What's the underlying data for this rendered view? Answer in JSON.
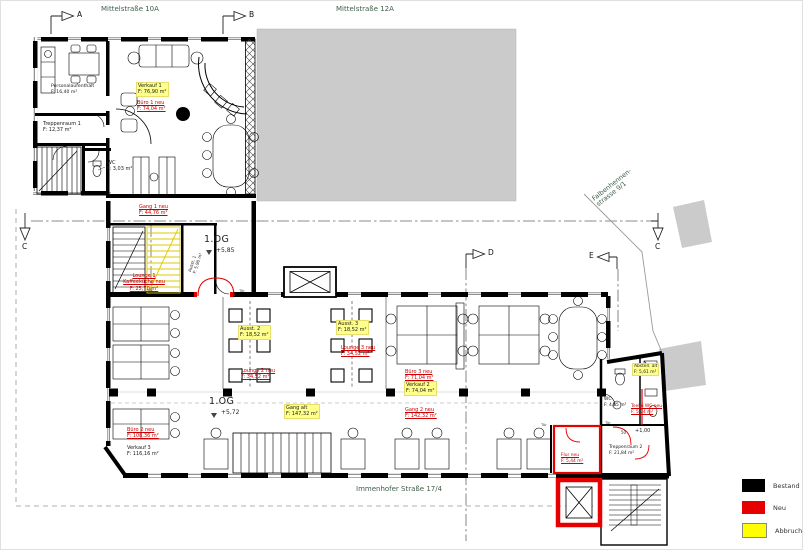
{
  "streets": {
    "top_left": "Mittelstraße 10A",
    "top_right": "Mittelstraße 12A",
    "bottom": "Immenhofer Straße 17/4",
    "right_line1": "Falbenhennen-",
    "right_line2": "strasse 9/1"
  },
  "markers": {
    "a": "A",
    "b": "B",
    "c_left": "C",
    "c_right": "C",
    "d": "D",
    "e": "E"
  },
  "levels": {
    "og585": {
      "name": "1.OG",
      "value": "+5,85"
    },
    "og572": {
      "name": "1.OG",
      "value": "+5,72"
    },
    "entry": {
      "value": "+1,00"
    },
    "door_width": "50"
  },
  "door_label": "Tür",
  "rooms": {
    "personalaufenthalt": {
      "name": "Personalaufenthalt",
      "area": "F: 16,40 m²",
      "status": "bestand"
    },
    "treppenraum1": {
      "name": "Treppenraum 1",
      "area": "F: 12,37 m²",
      "status": "bestand"
    },
    "wc1": {
      "name": "WC",
      "area": "F: 3,03 m²",
      "status": "bestand"
    },
    "verkauf1": {
      "name": "Verkauf 1",
      "area": "F: 76,90 m²",
      "status": "abbruch"
    },
    "buero1": {
      "name": "Büro 1 neu",
      "area": "F: 74,04 m²",
      "status": "neu"
    },
    "gang1": {
      "name": "Gang 1 neu",
      "area": "F: 44,76 m²",
      "status": "neu"
    },
    "lounge1": {
      "name": "Lounge 1 Kaffeeküche neu",
      "area": "F: 25,70 m²",
      "status": "neu"
    },
    "ausst1": {
      "name": "Ausst. 1",
      "area": "F: 5,90 m²",
      "status": "bestand"
    },
    "ausst2": {
      "name": "Ausst. 2",
      "area": "F: 18,52 m²",
      "status": "abbruch"
    },
    "lounge2": {
      "name": "Lounge 2 neu",
      "area": "F: 34,52 m²",
      "status": "neu"
    },
    "ausst3": {
      "name": "Ausst. 3",
      "area": "F: 18,52 m²",
      "status": "abbruch"
    },
    "lounge3": {
      "name": "Lounge 3 neu",
      "area": "F: 34,52 m²",
      "status": "neu"
    },
    "buero3": {
      "name": "Büro 3 neu",
      "area": "F: 71,04 m²",
      "status": "neu"
    },
    "verkauf2": {
      "name": "Verkauf 2",
      "area": "F: 74,04 m²",
      "status": "abbruch"
    },
    "gang_alt": {
      "name": "Gang alt",
      "area": "F: 147,32 m²",
      "status": "abbruch"
    },
    "gang2": {
      "name": "Gang 2 neu",
      "area": "F: 142,32 m²",
      "status": "neu"
    },
    "buero2": {
      "name": "Büro 2 neu",
      "area": "F: 108,36 m²",
      "status": "neu"
    },
    "verkauf3": {
      "name": "Verkauf 3",
      "area": "F: 116,16 m²",
      "status": "bestand"
    },
    "wc2": {
      "name": "WC",
      "area": "F: 4,45 m²",
      "status": "bestand"
    },
    "teekue": {
      "name": "Teekü WC neu",
      "area": "F: 5,74 m²",
      "status": "neu"
    },
    "abstell": {
      "name": "Abstell. alt",
      "area": "F: 5,61 m²",
      "status": "abbruch"
    },
    "treppenraum2": {
      "name": "Treppenraum 2",
      "area": "F: 21,84 m²",
      "status": "bestand"
    },
    "flur_neu": {
      "name": "Flur neu",
      "area": "F: 5,44 m²",
      "status": "neu"
    }
  },
  "legend": {
    "items": [
      {
        "label": "Bestand",
        "color": "#000000"
      },
      {
        "label": "Neu",
        "color": "#e60000"
      },
      {
        "label": "Abbruch",
        "color": "#ffff00"
      }
    ]
  },
  "colors": {
    "bestand": "#000000",
    "neu": "#e60000",
    "abbruch": "#ffff00",
    "neighbor_gray": "#cacbca",
    "street_green": "#3f5e49",
    "label_highlight": "#ffff8c"
  }
}
